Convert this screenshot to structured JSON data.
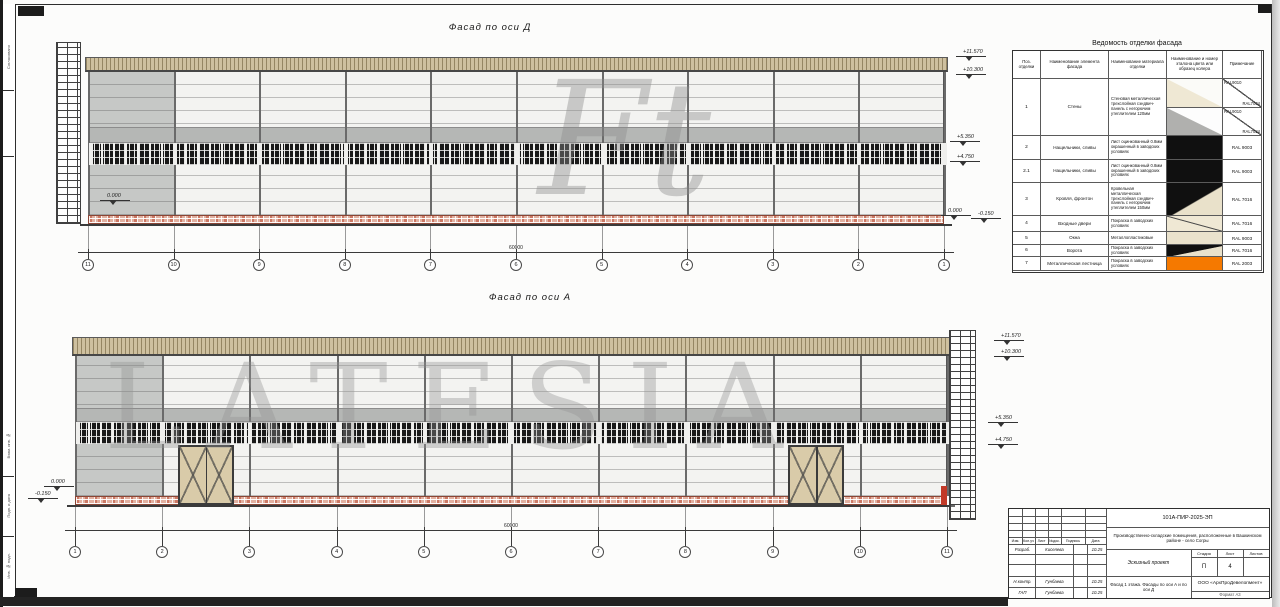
{
  "sheet": {
    "facades": [
      {
        "id": "D",
        "title": "Фасад по оси Д",
        "axes": [
          "11",
          "10",
          "9",
          "8",
          "7",
          "6",
          "5",
          "4",
          "3",
          "2",
          "1"
        ],
        "total_dim": "60000"
      },
      {
        "id": "A",
        "title": "Фасад по оси А",
        "axes": [
          "1",
          "2",
          "3",
          "4",
          "5",
          "6",
          "7",
          "8",
          "9",
          "10",
          "11"
        ],
        "total_dim": "60000"
      }
    ],
    "elevations": {
      "parapet": "+11.570",
      "eaves": "+10.300",
      "window_head": "+5.350",
      "window_sill": "+4.750",
      "zero": "0.000",
      "ground": "-0.150"
    }
  },
  "finish_table": {
    "title": "Ведомость отделки фасада",
    "columns": [
      "Поз. отделки",
      "Наименование элемента фасада",
      "Наименование материала отделки",
      "Наименование и номер эталона цвета или образец колера",
      "Примечание"
    ],
    "rows": [
      {
        "pos": "1",
        "element": "Стены",
        "material": "Стеновая металлическая трехслойная сэндвич-панель с негорючим утеплителем 120мм",
        "samples": [
          "cream",
          "gray"
        ],
        "notes_diag": [
          [
            "RAL9010",
            "RAL7004"
          ],
          [
            "RAL9010",
            "RAL7024"
          ]
        ]
      },
      {
        "pos": "2",
        "element": "Нащельники, сливы",
        "material": "Лист оцинкованный 0.8мм окрашенный в заводских условиях",
        "sample": "black",
        "note": "RAL 9003"
      },
      {
        "pos": "2.1",
        "element": "Нащельники, сливы",
        "material": "Лист оцинкованный 0.8мм окрашенный в заводских условиях",
        "sample": "black",
        "note": "RAL 9003"
      },
      {
        "pos": "3",
        "element": "Кровля, фронтон",
        "material": "Кровельная металлическая трехслойная сэндвич-панель с негорючим утеплителем 150мм",
        "sample": "blackbeige",
        "note": "RAL 7016"
      },
      {
        "pos": "4",
        "element": "Входные двери",
        "material": "Покраска в заводских условиях",
        "sample": "beigeline",
        "note": "RAL 7016"
      },
      {
        "pos": "5",
        "element": "Окна",
        "material": "Металлопластиковые",
        "sample": "beige",
        "note": "RAL 9003"
      },
      {
        "pos": "6",
        "element": "Ворота",
        "material": "Покраска в заводских условиях",
        "sample": "blackbeige",
        "note": "RAL 7016"
      },
      {
        "pos": "7",
        "element": "Металлическая лестница",
        "material": "Покраска в заводских условиях",
        "sample": "orange",
        "note": "RAL 2003"
      }
    ]
  },
  "title_block": {
    "code": "101А-ПИР-2025-ЭП",
    "project": "Производственно-складские помещения, расположенные в Вашкинском районе - село Согры",
    "doc_type": "Эскизный проект",
    "stage_label": "Стадия",
    "sheet_label": "Лист",
    "sheets_label": "Листов",
    "stage": "П",
    "sheet_no": "4",
    "sheet_title": "Фасад 1 этажа. Фасады по оси А и по оси Д",
    "company": "ООО «АрхПроДевелопмент»",
    "format": "Формат А3",
    "sig_header": [
      "Изм.",
      "Кол.уч",
      "Лист",
      "№док.",
      "Подпись",
      "Дата"
    ],
    "signatures": [
      {
        "role": "Разраб.",
        "name": "Киселева",
        "date": "10.25"
      },
      {
        "role": "Н.контр.",
        "name": "Гунбаева",
        "date": "10.25"
      },
      {
        "role": "ГАП",
        "name": "Гунбаева",
        "date": "10.25"
      }
    ]
  },
  "frame": {
    "labels": [
      "Согласовано",
      "Взам. инв. №",
      "Подп. и дата",
      "Инв. № подл."
    ]
  },
  "watermarks": {
    "large": "LATESIA",
    "monogram": "Ft"
  }
}
